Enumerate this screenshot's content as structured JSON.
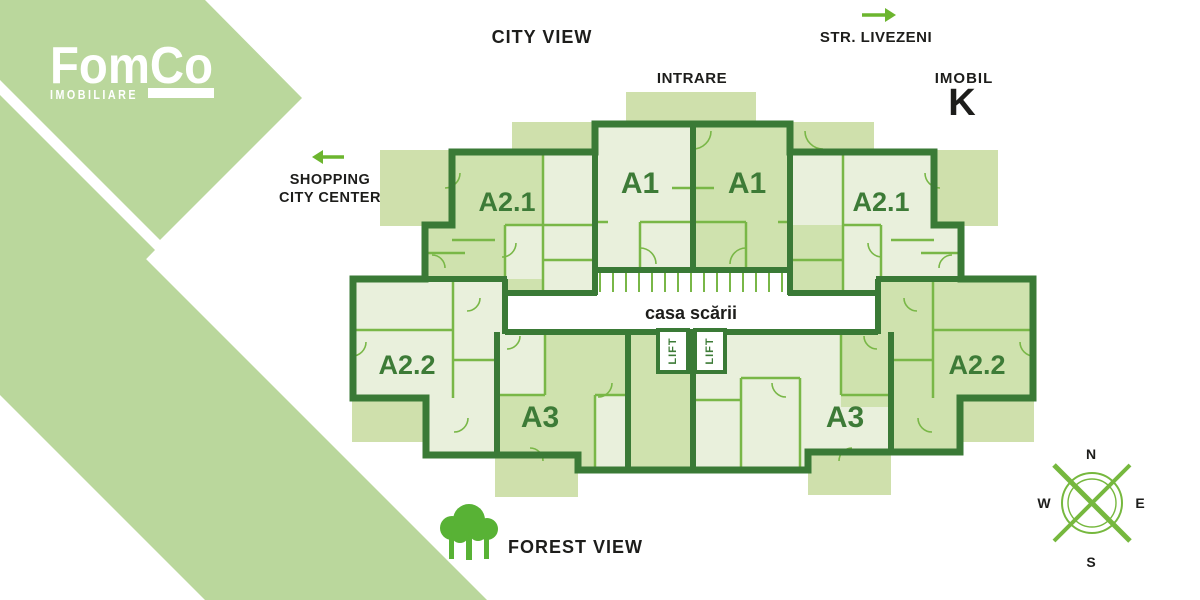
{
  "logo": {
    "name": "FomCo",
    "tagline": "IMOBILIARE"
  },
  "context_labels": {
    "city_view": "CITY VIEW",
    "intrare": "INTRARE",
    "str_livezeni": "STR. LIVEZENI",
    "imobil": "IMOBIL",
    "block": "K",
    "shopping_line1": "SHOPPING",
    "shopping_line2": "CITY CENTER",
    "forest_view": "FOREST VIEW"
  },
  "floor_plan": {
    "staircase_label": "casa scării",
    "lift_label": "LIFT",
    "apartments": [
      {
        "id": "a21-left",
        "label": "A2.1"
      },
      {
        "id": "a1-left",
        "label": "A1"
      },
      {
        "id": "a1-right",
        "label": "A1"
      },
      {
        "id": "a21-right",
        "label": "A2.1"
      },
      {
        "id": "a22-left",
        "label": "A2.2"
      },
      {
        "id": "a3-left",
        "label": "A3"
      },
      {
        "id": "a3-right",
        "label": "A3"
      },
      {
        "id": "a22-right",
        "label": "A2.2"
      }
    ]
  },
  "compass": {
    "n": "N",
    "s": "S",
    "e": "E",
    "w": "W"
  },
  "colors": {
    "brand_green": "#bad79c",
    "balcony_green": "#cfe0ac",
    "room_light": "#e9f0dc",
    "room_medium": "#cfe2ae",
    "wall_dark": "#3a7a36",
    "wall_thin": "#79b747",
    "accent_green": "#6cb52e",
    "label_green": "#3d7b37",
    "text_dark": "#1d1d1b"
  }
}
